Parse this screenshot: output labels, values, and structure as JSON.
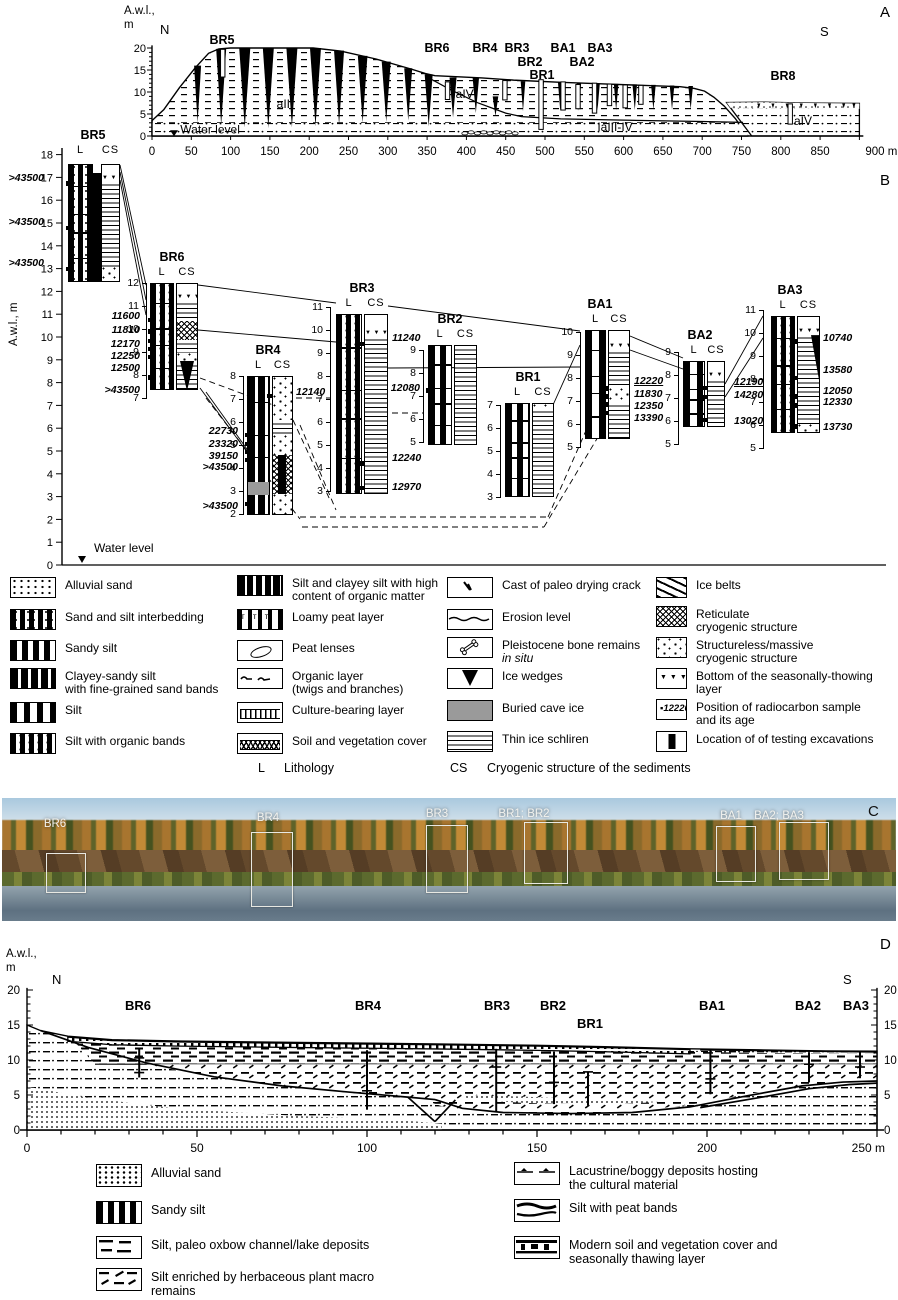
{
  "panelA": {
    "label": "A",
    "axis_label_line1": "A.w.l.,",
    "axis_label_line2": "m",
    "north": "N",
    "south": "S",
    "water_level": "Water level",
    "yticks": [
      "0",
      "5",
      "10",
      "15",
      "20"
    ],
    "xticks": [
      "0",
      "50",
      "100",
      "150",
      "200",
      "250",
      "300",
      "350",
      "400",
      "450",
      "500",
      "550",
      "600",
      "650",
      "700",
      "750",
      "800",
      "850",
      "900 m"
    ],
    "sites": [
      "BR5",
      "BR6",
      "BR4",
      "BR3",
      "BA1",
      "BA3",
      "BR2",
      "BA2",
      "BR1",
      "BR8"
    ],
    "units": [
      "aIII",
      "IaIV",
      "IaIII-IV",
      "aIV"
    ]
  },
  "panelB": {
    "label": "B",
    "axis_label": "A.w.l., m",
    "water_level": "Water level",
    "header_l": "L",
    "header_cs": "CS",
    "columns": [
      {
        "name": "BR5",
        "dates_left": [
          ">43500",
          ">43500",
          ">43500"
        ],
        "dates_left_elev": [
          16.75,
          14.8,
          13.0
        ],
        "dates_right": [],
        "dates_right_elev": []
      },
      {
        "name": "BR6",
        "dates_left": [
          "11600",
          "11810",
          "12170",
          "12250",
          "12500",
          ">43500"
        ],
        "dates_left_elev": [
          10.4,
          9.9,
          9.5,
          9.15,
          8.8,
          7.9
        ],
        "dates_right": [],
        "dates_right_elev": []
      },
      {
        "name": "BR4",
        "dates_left": [
          "22730",
          "23320",
          "39150",
          ">43500",
          ">43500"
        ],
        "dates_left_elev": [
          5.45,
          5.05,
          4.7,
          4.35,
          2.45
        ],
        "dates_right": [
          "12140"
        ],
        "dates_right_elev": [
          7.15
        ]
      },
      {
        "name": "BR3",
        "dates_left": [],
        "dates_left_elev": [],
        "dates_right": [
          "11240",
          "12240",
          "12970"
        ],
        "dates_right_elev": [
          9.4,
          4.2,
          3.15
        ]
      },
      {
        "name": "BR2",
        "dates_left": [
          "12080"
        ],
        "dates_left_elev": [
          7.25
        ],
        "dates_right": [],
        "dates_right_elev": []
      },
      {
        "name": "BR1",
        "dates_left": [],
        "dates_left_elev": [],
        "dates_right": [],
        "dates_right_elev": []
      },
      {
        "name": "BA1",
        "dates_left": [],
        "dates_left_elev": [],
        "dates_right": [
          "12220",
          "11830",
          "12350",
          "13390"
        ],
        "dates_right_elev": [
          7.55,
          7.2,
          6.85,
          6.5
        ],
        "underline_first": true
      },
      {
        "name": "BA2",
        "dates_left": [],
        "dates_left_elev": [],
        "dates_right": [
          "12190",
          "14280",
          "13020"
        ],
        "dates_right_elev": [
          7.45,
          7.05,
          6.05
        ],
        "underline_first": true
      },
      {
        "name": "BA3",
        "dates_left": [],
        "dates_left_elev": [],
        "dates_right": [
          "10740",
          "13580",
          "12050",
          "12330",
          "13730"
        ],
        "dates_right_elev": [
          9.65,
          8.05,
          7.25,
          6.85,
          5.95
        ]
      }
    ]
  },
  "legendB": {
    "c14_sample": "12220",
    "l_abbrev": "L",
    "l_label": "Lithology",
    "cs_abbrev": "CS",
    "cs_label": "Cryogenic structure of the sediments",
    "columns": [
      [
        {
          "pat": "alluvial",
          "label": "Alluvial sand"
        },
        {
          "pat": "interbed",
          "label": "Sand and silt interbedding"
        },
        {
          "pat": "sandy-silt",
          "label": "Sandy silt"
        },
        {
          "pat": "clayey",
          "label": "Clayey-sandy silt\nwith fine-grained sand bands"
        },
        {
          "pat": "silt",
          "label": "Silt"
        },
        {
          "pat": "silt-organic",
          "label": "Silt with organic bands"
        }
      ],
      [
        {
          "pat": "high-organic",
          "label": "Silt and clayey silt with high\ncontent of organic matter"
        },
        {
          "pat": "loamy-peat",
          "label": "Loamy peat layer"
        },
        {
          "pat": "peat-lens",
          "label": "Peat lenses"
        },
        {
          "pat": "organic-layer",
          "label": "Organic layer\n(twigs and branches)"
        },
        {
          "pat": "culture",
          "label": "Culture-bearing layer"
        },
        {
          "pat": "soil-cover",
          "label": "Soil and vegetation cover"
        }
      ],
      [
        {
          "pat": "crack",
          "label": "Cast of paleo drying crack"
        },
        {
          "pat": "erosion",
          "label": "Erosion level"
        },
        {
          "pat": "bone",
          "label": "Pleistocene bone remains",
          "label_italic": "in situ"
        },
        {
          "pat": "ice-wedge",
          "label": "Ice wedges"
        },
        {
          "pat": "cave-ice",
          "label": "Buried cave ice"
        },
        {
          "pat": "schliren",
          "label": "Thin ice schliren"
        }
      ],
      [
        {
          "pat": "ice-belts",
          "label": "Ice belts"
        },
        {
          "pat": "reticulate",
          "label": "Reticulate\ncryogenic structure"
        },
        {
          "pat": "massive",
          "label": "Structureless/massive\ncryogenic structure"
        },
        {
          "pat": "thaw-bottom",
          "label": "Bottom of the seasonally-thowing\nlayer"
        },
        {
          "pat": "c14",
          "label": "Position of radiocarbon sample\nand its age"
        },
        {
          "pat": "excavation",
          "label": "Location of of testing excavations"
        }
      ]
    ]
  },
  "panelC": {
    "label": "C",
    "sites": [
      "BR6",
      "BR4",
      "BR3",
      "BR1; BR2",
      "BA1",
      "BA2; BA3"
    ]
  },
  "panelD": {
    "label": "D",
    "axis_label_line1": "A.w.l.,",
    "axis_label_line2": "m",
    "north": "N",
    "south": "S",
    "yticks": [
      "0",
      "5",
      "10",
      "15",
      "20"
    ],
    "xticks": [
      "0",
      "50",
      "100",
      "150",
      "200",
      "250 m"
    ],
    "sites": [
      "BR6",
      "BR4",
      "BR3",
      "BR2",
      "BR1",
      "BA1",
      "BA2",
      "BA3"
    ]
  },
  "legendD": {
    "left": [
      {
        "pat": "d-alluvial",
        "label": "Alluvial sand"
      },
      {
        "pat": "d-sandy-silt",
        "label": "Sandy silt"
      },
      {
        "pat": "d-oxbow",
        "label": "Silt, paleo oxbow channel/lake deposits"
      },
      {
        "pat": "d-herb",
        "label": "Silt enriched by herbaceous plant macro\nremains"
      }
    ],
    "right": [
      {
        "pat": "d-lacustrine",
        "label": "Lacustrine/boggy deposits hosting\nthe cultural material"
      },
      {
        "pat": "d-peat-bands",
        "label": "Silt with peat bands"
      },
      {
        "pat": "d-modern-soil",
        "label": "Modern soil and vegetation cover and\nseasonally thawing layer"
      }
    ]
  }
}
